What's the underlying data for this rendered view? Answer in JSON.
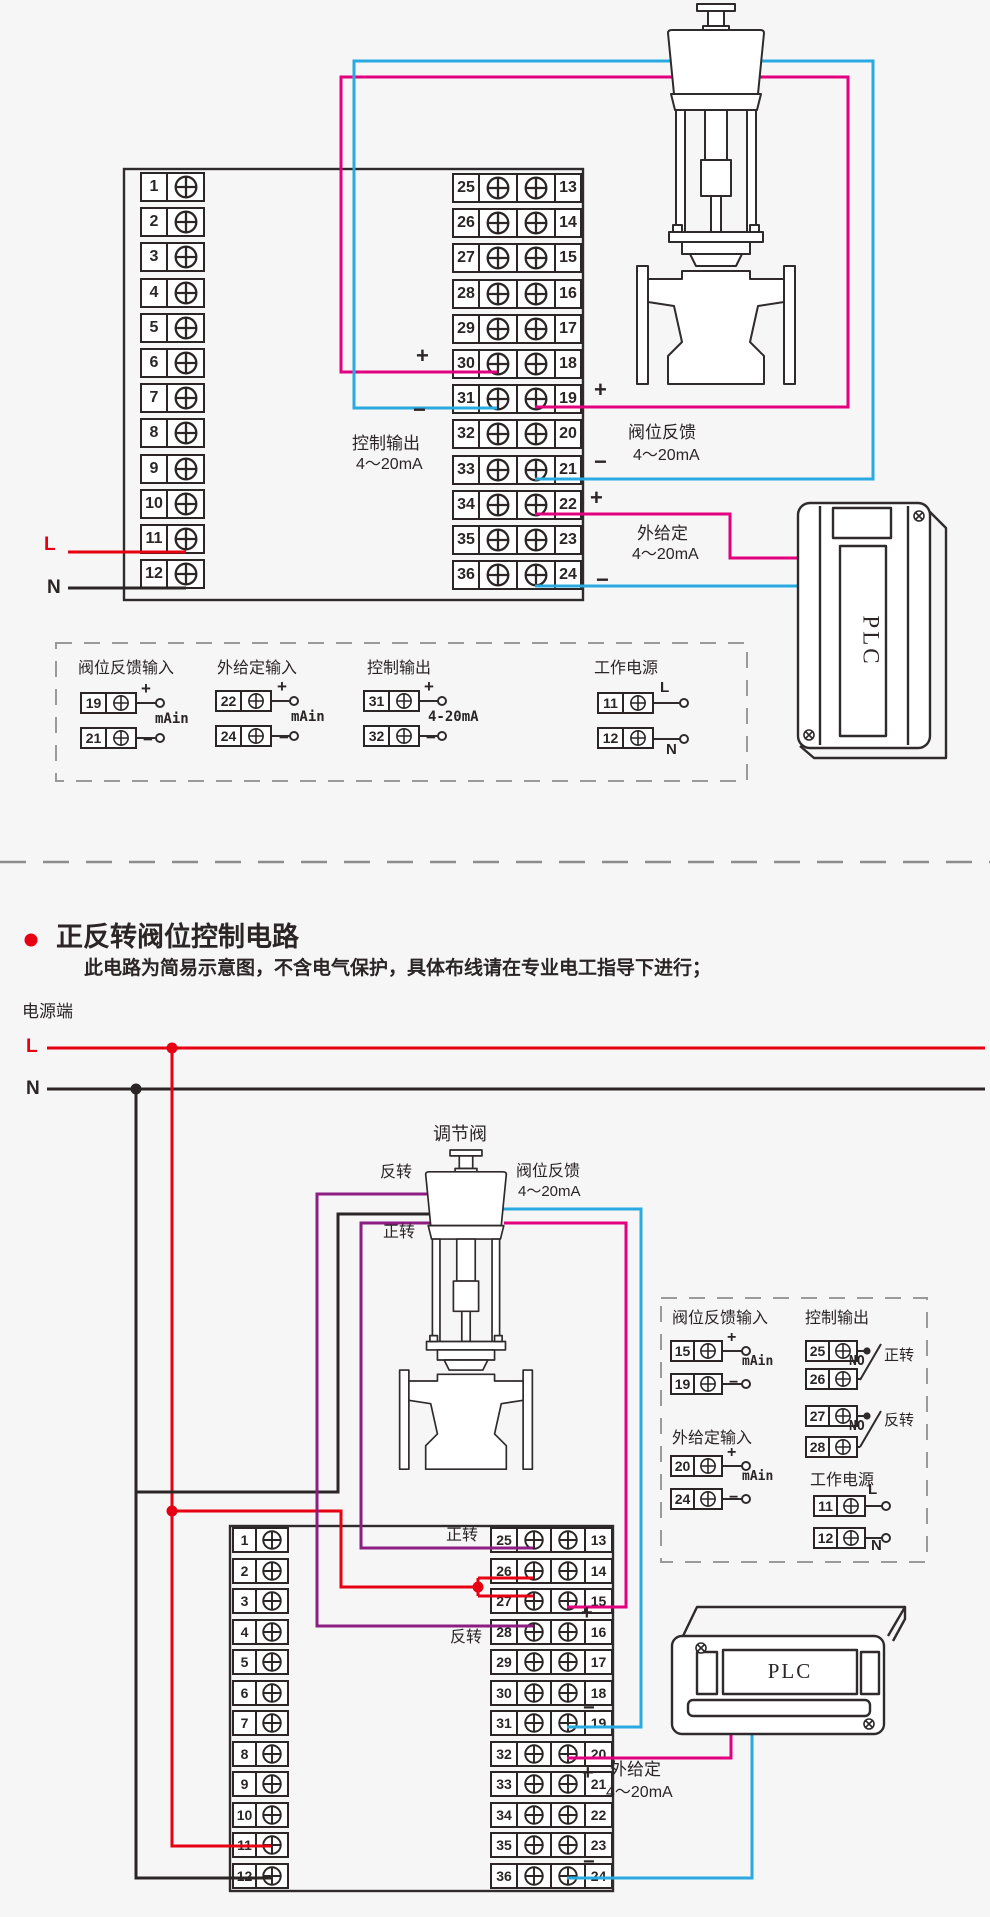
{
  "colors": {
    "red": "#e60012",
    "pink": "#e3007f",
    "blue": "#29abe2",
    "purple": "#8c1d82",
    "line": "#2b2526",
    "dash": "#9a9a9a"
  },
  "section1": {
    "left_terminals": [
      "1",
      "2",
      "3",
      "4",
      "5",
      "6",
      "7",
      "8",
      "9",
      "10",
      "11",
      "12"
    ],
    "mid_left_terminals": [
      "25",
      "26",
      "27",
      "28",
      "29",
      "30",
      "31",
      "32",
      "33",
      "34",
      "35",
      "36"
    ],
    "mid_right_terminals": [
      "13",
      "14",
      "15",
      "16",
      "17",
      "18",
      "19",
      "20",
      "21",
      "22",
      "23",
      "24"
    ],
    "plus": "+",
    "minus": "−",
    "l": "L",
    "n": "N",
    "plc": "PLC",
    "control_output": {
      "line1": "控制输出",
      "line2": "4～20mA"
    },
    "valve_feedback": {
      "line1": "阀位反馈",
      "line2": "4～20mA"
    },
    "external_set": {
      "line1": "外给定",
      "line2": "4～20mA"
    },
    "box_groups": [
      {
        "title": "阀位反馈输入",
        "top_num": "19",
        "top_sign": "+",
        "bot_num": "21",
        "bot_sign": "−",
        "label": "mAin"
      },
      {
        "title": "外给定输入",
        "top_num": "22",
        "top_sign": "+",
        "bot_num": "24",
        "bot_sign": "−",
        "label": "mAin"
      },
      {
        "title": "控制输出",
        "top_num": "31",
        "top_sign": "+",
        "bot_num": "32",
        "bot_sign": "−",
        "label": "4-20mA"
      },
      {
        "title": "工作电源",
        "top_num": "11",
        "top_sign": "L",
        "bot_num": "12",
        "bot_sign": "N",
        "label": ""
      }
    ]
  },
  "section2": {
    "bullet_title": "正反转阀位控制电路",
    "subtitle": "此电路为简易示意图，不含电气保护，具体布线请在专业电工指导下进行；",
    "power_terminal": "电源端",
    "l": "L",
    "n": "N",
    "plc": "PLC",
    "valve": "调节阀",
    "forward": "正转",
    "reverse": "反转",
    "plus": "+",
    "minus": "−",
    "valve_feedback": {
      "line1": "阀位反馈",
      "line2": "4～20mA"
    },
    "external_set": {
      "line1": "外给定",
      "line2": "4～20mA"
    },
    "left_terminals": [
      "1",
      "2",
      "3",
      "4",
      "5",
      "6",
      "7",
      "8",
      "9",
      "10",
      "11",
      "12"
    ],
    "mid_left_terminals": [
      "25",
      "26",
      "27",
      "28",
      "29",
      "30",
      "31",
      "32",
      "33",
      "34",
      "35",
      "36"
    ],
    "mid_right_terminals": [
      "13",
      "14",
      "15",
      "16",
      "17",
      "18",
      "19",
      "20",
      "21",
      "22",
      "23",
      "24"
    ],
    "box2": {
      "g1": {
        "title": "阀位反馈输入",
        "rows": [
          [
            "15",
            "+"
          ],
          [
            "19",
            "−"
          ]
        ],
        "label": "mAin"
      },
      "g2": {
        "title": "外给定输入",
        "rows": [
          [
            "20",
            "+"
          ],
          [
            "24",
            "−"
          ]
        ],
        "label": "mAin"
      },
      "g3": {
        "title": "控制输出",
        "pairs": [
          {
            "top": "25",
            "bot": "26",
            "no": "NO",
            "dir": "正转"
          },
          {
            "top": "27",
            "bot": "28",
            "no": "NO",
            "dir": "反转"
          }
        ]
      },
      "g4": {
        "title": "工作电源",
        "rows": [
          [
            "11",
            "L"
          ],
          [
            "12",
            "N"
          ]
        ]
      }
    }
  }
}
